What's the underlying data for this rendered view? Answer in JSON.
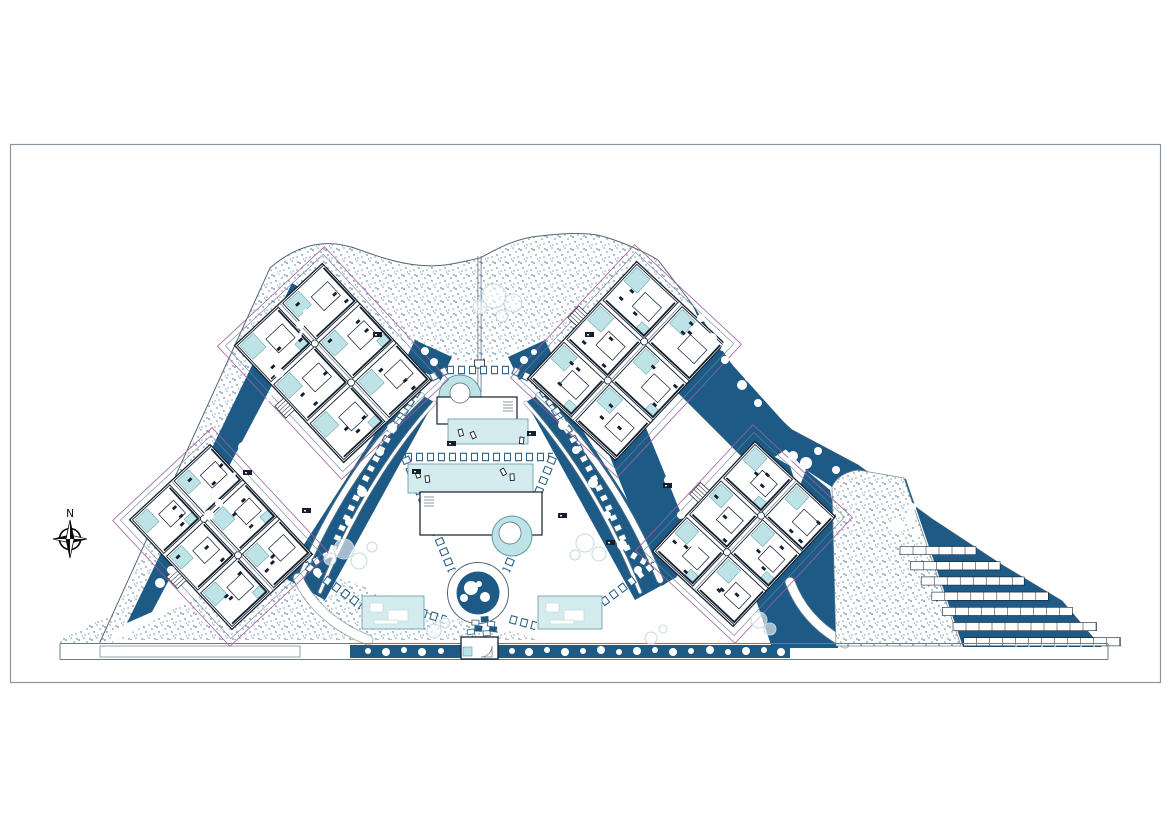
{
  "meta": {
    "drawing_type": "architectural-site-plan",
    "sheet": "landscape-masterplan"
  },
  "compass": {
    "label": "N"
  },
  "palette": {
    "dark": "#1E5A86",
    "darkDeep": "#17507A",
    "wall": "#131F2E",
    "line": "#6E8291",
    "boundary": "#55656F",
    "pageBorder": "#8C959B",
    "magenta": "#A2609C",
    "pool": "#BEE3E7",
    "poolDeck": "#D5ECEE",
    "poolStroke": "#5E98A6",
    "stippleDot1": "#2E6088",
    "stippleDot2": "#7FA6BC",
    "shrub": "#C3DBE1",
    "roadLine": "#6B7A84",
    "tree": "#FFFFFF",
    "chainDark": "#2A5F86"
  },
  "plan": {
    "sheet_rect": [
      10,
      144,
      1150,
      538
    ],
    "boundary_path": "M100,642 L270,268 C300,242 330,238 360,250 C395,263 420,268 445,265 C460,263 470,260 480,258 C495,250 515,238 540,236 C565,233 590,232 605,237 C625,243 645,252 658,260 L692,304 L725,355 L750,392 L792,430 L858,465 L932,519 L1002,565 L1062,601 L1101,647",
    "stipple_regions": [
      {
        "name": "stipple-top-band",
        "layer": 1,
        "path": "M270,268 C300,242 330,238 360,250 C395,263 420,268 445,265 C460,263 470,260 480,258 C495,250 515,238 540,236 C565,233 590,232 605,237 C625,243 645,252 658,260 L692,304 L660,300 L625,303 L596,318 L565,340 L535,352 L510,360 L480,363 L450,360 L425,352 L398,338 L372,318 L340,298 L305,288 Z"
      },
      {
        "name": "stipple-left-band",
        "layer": 1,
        "path": "M270,268 L293,283 L128,622 L104,640 Z"
      },
      {
        "name": "stipple-bottom-left",
        "layer": 1,
        "path": "M118,640 L278,552 L420,610 L545,640 Z"
      },
      {
        "name": "stipple-outer-triangle",
        "layer": 1,
        "path": "M50,644 L113,612 L113,644 Z"
      },
      {
        "name": "stipple-right-wedge",
        "layer": 2,
        "base": true,
        "path": "M832,487 Q838,473 858,470 L904,478 L961,646 L836,646 Z"
      }
    ],
    "dark_regions": [
      "M292,283 L318,298 L152,612 L127,623 Z",
      "M406,386 L434,402 L325,600 L283,577 Z",
      "M415,340 L452,357 L441,380 L404,363 Z",
      "M545,340 L508,357 L519,380 L556,363 Z",
      "M554,386 L526,402 L635,600 L677,577 Z",
      "M600,432 L642,418 L700,560 L662,586 Z",
      "M640,300 L710,340 L800,440 L755,470 L655,370 Z",
      "M755,445 L790,466 L838,615 L800,640 Z",
      "M806,470 L830,490 L836,520 L838,648 L772,648 L756,600 Z",
      "M692,304 L725,355 L750,392 L792,430 L858,465 L932,519 L1002,565 L1062,601 L1101,647 L963,647 L906,479 L858,471 L832,487 L806,470 L757,420 L706,335 Z",
      "M350,645 L462,645 L462,658 L350,658 Z",
      "M497,645 L790,645 L790,658 L497,658 Z"
    ],
    "white_arcs": [
      {
        "path": "M421,396 Q345,470 300,580",
        "w": 6
      },
      {
        "path": "M434,403 Q365,480 320,592",
        "w": 3
      },
      {
        "path": "M539,396 Q615,470 660,580",
        "w": 6
      },
      {
        "path": "M526,403 Q595,480 640,592",
        "w": 3
      },
      {
        "path": "M298,578 Q318,620 368,640",
        "w": 9
      },
      {
        "path": "M790,582 Q805,622 845,643",
        "w": 9
      }
    ],
    "paver_paths": [
      "M447,370 L513,370",
      "M447,370 L424,381",
      "M513,370 L536,381",
      "M424,381 Q375,450 331,553 L307,566",
      "M536,381 Q585,450 629,553 L652,566",
      "M405,457 L553,457",
      "M405,457 L452,571",
      "M553,457 L506,571",
      "M307,566 L362,606",
      "M652,566 L598,606",
      "M420,612 L446,620",
      "M510,619 L536,626"
    ],
    "axis_line": {
      "x": 479.5,
      "y1": 256,
      "y2": 392
    },
    "road": {
      "x1": 60,
      "x2": 1108,
      "y_top": 643.5,
      "y_bot": 659.5,
      "tick_x1": 1016,
      "tick_x2": 1102,
      "tick_step": 13
    },
    "parking": {
      "rows": 7,
      "x0": 900,
      "y0": 546.5,
      "dx": 10.6,
      "dy": 15.2,
      "w0": 76,
      "dw": 4.5,
      "h": 8.2,
      "cell": 13
    },
    "amenities": {
      "upper_pool": {
        "circle": [
          460,
          396,
          21
        ],
        "island": [
          460,
          393,
          10
        ]
      },
      "upper_bldg": [
        437,
        397,
        80,
        27
      ],
      "upper_deck": [
        448,
        419,
        80,
        25
      ],
      "lower_deck": [
        408,
        464,
        125,
        29
      ],
      "lower_bldg": [
        420,
        492,
        122,
        43
      ],
      "lower_pool": {
        "circle": [
          512,
          536,
          20
        ],
        "island": [
          510,
          533,
          11
        ]
      },
      "hub": {
        "cx": 478,
        "cy": 593,
        "r_outer": 30.5,
        "r_inner": 21.5
      },
      "court_left": [
        362,
        596,
        62,
        33
      ],
      "court_right": [
        538,
        596,
        64,
        33
      ],
      "entrance": [
        461,
        637,
        37,
        22
      ],
      "chairs": [
        [
          458,
          430
        ],
        [
          470,
          433
        ],
        [
          520,
          437
        ],
        [
          415,
          472
        ],
        [
          425,
          476
        ],
        [
          500,
          470
        ],
        [
          510,
          474
        ]
      ]
    },
    "blocks": [
      {
        "id": "a",
        "cx": 333,
        "cy": 363,
        "rot": -43,
        "w": 120,
        "h": 160
      },
      {
        "id": "b",
        "cx": 626,
        "cy": 361,
        "rot": 43,
        "w": 120,
        "h": 160
      },
      {
        "id": "c",
        "cx": 221,
        "cy": 537,
        "rot": -43,
        "w": 110,
        "h": 150
      },
      {
        "id": "d",
        "cx": 744,
        "cy": 534,
        "rot": 43,
        "w": 110,
        "h": 150
      }
    ],
    "trees_dark": [
      [
        160,
        583,
        5
      ],
      [
        171,
        570,
        4
      ],
      [
        209,
        515,
        5
      ],
      [
        219,
        503,
        4
      ],
      [
        243,
        447,
        5
      ],
      [
        252,
        433,
        4
      ],
      [
        279,
        373,
        5
      ],
      [
        290,
        352,
        4
      ],
      [
        300,
        325,
        4
      ],
      [
        306,
        312,
        3
      ],
      [
        392,
        428,
        5
      ],
      [
        380,
        452,
        4
      ],
      [
        362,
        492,
        5
      ],
      [
        349,
        522,
        4
      ],
      [
        333,
        553,
        5
      ],
      [
        317,
        572,
        4
      ],
      [
        425,
        351,
        4
      ],
      [
        434,
        362,
        4
      ],
      [
        428,
        343,
        3
      ],
      [
        513,
        350,
        4
      ],
      [
        524,
        360,
        4
      ],
      [
        534,
        352,
        3
      ],
      [
        547,
        371,
        4
      ],
      [
        554,
        383,
        3
      ],
      [
        563,
        425,
        5
      ],
      [
        576,
        450,
        4
      ],
      [
        593,
        483,
        5
      ],
      [
        607,
        515,
        4
      ],
      [
        622,
        545,
        5
      ],
      [
        638,
        570,
        4
      ],
      [
        668,
        480,
        4
      ],
      [
        681,
        515,
        4
      ],
      [
        695,
        545,
        4
      ],
      [
        701,
        318,
        4
      ],
      [
        712,
        338,
        5
      ],
      [
        725,
        360,
        4
      ],
      [
        742,
        385,
        5
      ],
      [
        758,
        403,
        4
      ],
      [
        793,
        456,
        5
      ],
      [
        806,
        463,
        6
      ],
      [
        818,
        451,
        4
      ],
      [
        836,
        470,
        4
      ],
      [
        898,
        526,
        7
      ],
      [
        911,
        519,
        5
      ],
      [
        917,
        533,
        4
      ],
      [
        912,
        507,
        4
      ],
      [
        368,
        651,
        3
      ],
      [
        386,
        652,
        4
      ],
      [
        404,
        650,
        3
      ],
      [
        422,
        652,
        4
      ],
      [
        441,
        651,
        3
      ],
      [
        512,
        651,
        3
      ],
      [
        529,
        652,
        4
      ],
      [
        547,
        650,
        3
      ],
      [
        565,
        652,
        4
      ],
      [
        583,
        651,
        3
      ],
      [
        601,
        650,
        4
      ],
      [
        619,
        652,
        3
      ],
      [
        637,
        651,
        4
      ],
      [
        655,
        650,
        3
      ],
      [
        673,
        652,
        4
      ],
      [
        691,
        651,
        3
      ],
      [
        710,
        650,
        4
      ],
      [
        728,
        652,
        3
      ],
      [
        746,
        651,
        4
      ],
      [
        764,
        650,
        3
      ],
      [
        781,
        652,
        4
      ],
      [
        471,
        588,
        7
      ],
      [
        485,
        597,
        5
      ],
      [
        464,
        598,
        4
      ],
      [
        479,
        584,
        3
      ]
    ],
    "hedge_dashes": [
      [
        186,
        548
      ],
      [
        230,
        480
      ],
      [
        266,
        400
      ],
      [
        297,
        338
      ],
      [
        720,
        350
      ],
      [
        745,
        380
      ]
    ],
    "shrubs": [
      [
        344,
        549,
        10
      ],
      [
        359,
        561,
        8
      ],
      [
        330,
        559,
        6
      ],
      [
        372,
        547,
        5
      ],
      [
        585,
        543,
        9
      ],
      [
        599,
        554,
        7
      ],
      [
        575,
        555,
        5
      ],
      [
        494,
        296,
        12
      ],
      [
        513,
        303,
        9
      ],
      [
        480,
        307,
        7
      ],
      [
        502,
        316,
        6
      ],
      [
        434,
        631,
        7
      ],
      [
        445,
        623,
        5
      ],
      [
        759,
        620,
        8
      ],
      [
        770,
        629,
        6
      ],
      [
        651,
        638,
        6
      ],
      [
        663,
        629,
        4
      ]
    ],
    "chips": [
      [
        447,
        441
      ],
      [
        527,
        431
      ],
      [
        412,
        469
      ],
      [
        558,
        513
      ],
      [
        302,
        508
      ],
      [
        243,
        470
      ],
      [
        606,
        540
      ],
      [
        663,
        483
      ],
      [
        373,
        332
      ],
      [
        585,
        332
      ]
    ],
    "entrance_pavers": [
      [
        467,
        630
      ],
      [
        475,
        626
      ],
      [
        483,
        631
      ],
      [
        490,
        626
      ],
      [
        472,
        620
      ],
      [
        481,
        617
      ],
      [
        488,
        621
      ]
    ],
    "compass_pos": {
      "cx": 70,
      "cy": 539,
      "label_y": 517
    },
    "stipple_dots": [
      [
        1,
        3,
        0.8
      ],
      [
        6,
        1,
        0.6
      ],
      [
        9,
        5,
        0.9
      ],
      [
        3,
        8,
        0.7
      ],
      [
        11,
        10,
        0.6
      ],
      [
        7,
        11,
        0.8
      ],
      [
        4.5,
        12,
        0.5
      ],
      [
        12,
        2,
        0.7
      ]
    ]
  }
}
